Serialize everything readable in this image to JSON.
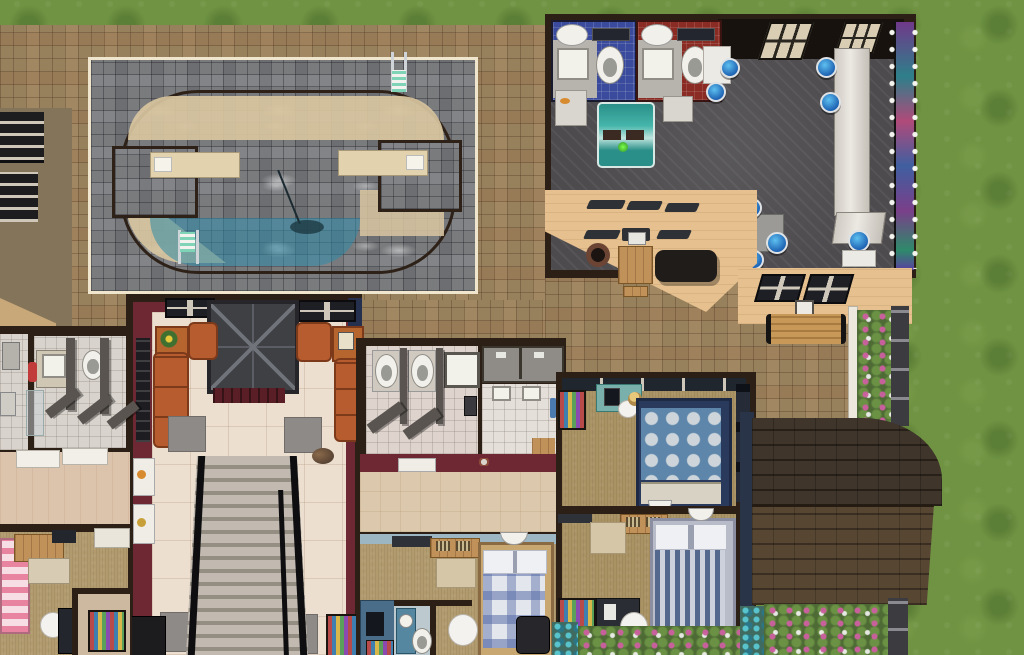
{
  "meta": {
    "type": "game-screenshot",
    "description": "Top-down life-simulation game lot view (Sims-style build/buy view) showing an outdoor pool plaza, a recreation building, a hotel-style lobby with staircase, bedrooms, bathrooms, a roofed wing and gardens",
    "canvas": {
      "width": 1024,
      "height": 655
    },
    "visible_text": "none"
  },
  "palette": {
    "grass": "#6f9342",
    "plaza_cobblestone": "#97805c",
    "pool_patio_cobblestone": "#7a7b7d",
    "patio_trim": "#efe6cd",
    "pool_water": "#3aa4c8",
    "pool_ledge_tan": "#d9c6a0",
    "dark_wall": "#2c1f15",
    "maroon_wall": "#6e2834",
    "tan_exterior_wall": "#e6c18f",
    "lobby_floor": "#ecdfd0",
    "game_hall_floor": "#4d4b4e",
    "carpet": "#b19a6d",
    "sofa_orange": "#b75c2e",
    "stool_blue": "#1f64b4",
    "jukebox_teal": "#2a8f88",
    "roof_brown_dark": "#3f352a",
    "roof_brown_light": "#574732",
    "bathroom_blue_tile": "#3a4a9c",
    "bathroom_red_tile": "#8a2c24",
    "flower_pink": "#cd5fa0",
    "flower_teal": "#5ac8d2"
  },
  "scene": {
    "ground": {
      "grass": "lawn surrounding lot on top and right",
      "plaza": "brown cobblestone plaza covering most of the lot",
      "pool_patio": "gray cobblestone pool deck with cream trim"
    },
    "pool_area": {
      "pool": "large oval swimming pool with tan shallow ledges and two side cutouts",
      "objects": [
        "diving-platform-left",
        "diving-platform-right",
        "pool-ladder-top-right",
        "pool-ladder-bottom-left",
        "pool-skimmer"
      ]
    },
    "rec_building": {
      "rooms": [
        "bathroom-blue-tile",
        "bathroom-red-tile",
        "game-hall"
      ],
      "objects": [
        "toilets",
        "sinks",
        "mirrors",
        "door-mats",
        "jukebox",
        "bar-counter",
        "bar-stools-blue (8)",
        "dining-table-white (2)",
        "dining-table-gray",
        "arcade-machine-wall-with-lights",
        "wall-windows (2)",
        "exterior-windows (6)",
        "bbq-grill",
        "picnic-table",
        "fire-pit",
        "park-bench",
        "flower-bed",
        "stone-curb"
      ]
    },
    "lobby_building": {
      "rooms": [
        "lobby",
        "mens-bathroom",
        "side-room",
        "bedroom-pink",
        "kids-room"
      ],
      "objects": [
        "elevator-shaft",
        "staircase-wide",
        "handrails",
        "sofa-left",
        "sofa-right",
        "armchair-left",
        "armchair-right",
        "end-table-sunflower",
        "end-table-art",
        "wall-art",
        "wall-dispensers (2)",
        "floor-mats (4)",
        "tv-unit-left",
        "toy-shelf-right",
        "dog",
        "urinal-stalls",
        "bathroom-sink-counter",
        "fire-extinguisher",
        "pink-striped-bed",
        "desk-wood",
        "dresser",
        "computer-chair",
        "toy-box"
      ]
    },
    "dorm_building_center": {
      "rooms": [
        "stall-bathroom",
        "showers (2)",
        "washroom",
        "corridor",
        "bedroom-blue-plaid",
        "ensuite-bathroom"
      ],
      "objects": [
        "toilet-stalls (2)",
        "stall-sink",
        "wall-sinks (2)",
        "towel-blue",
        "wood-box",
        "door-mat",
        "plaid-bed",
        "wall-lamp",
        "desk-with-radiators",
        "storage-box",
        "white-chair",
        "dark-armchair",
        "computer-nook",
        "bookshelf-colorful",
        "ensuite-toilet",
        "blue-vanity"
      ]
    },
    "dorm_building_right": {
      "rooms": [
        "bedroom-polka-dot",
        "bedroom-striped"
      ],
      "objects": [
        "polka-dot-bed",
        "striped-bed",
        "pillows",
        "wall-lamps (2)",
        "desk-computer-sim-seated",
        "white-chairs (2)",
        "desk-with-radiators",
        "storage-box",
        "bookshelves-colorful (3)",
        "window-slats"
      ]
    },
    "roof_wing": {
      "roof": "brown shingled gable roof, dark upper slope and lighter lower slope, curved right end",
      "objects": [
        "stone-curb",
        "flower-garden-pink-white",
        "flower-garden-teal"
      ]
    },
    "neighbor_fragment_top_left": {
      "objects": [
        "dark-roof-windows (2)",
        "olive-wall",
        "tan-awning"
      ]
    }
  }
}
